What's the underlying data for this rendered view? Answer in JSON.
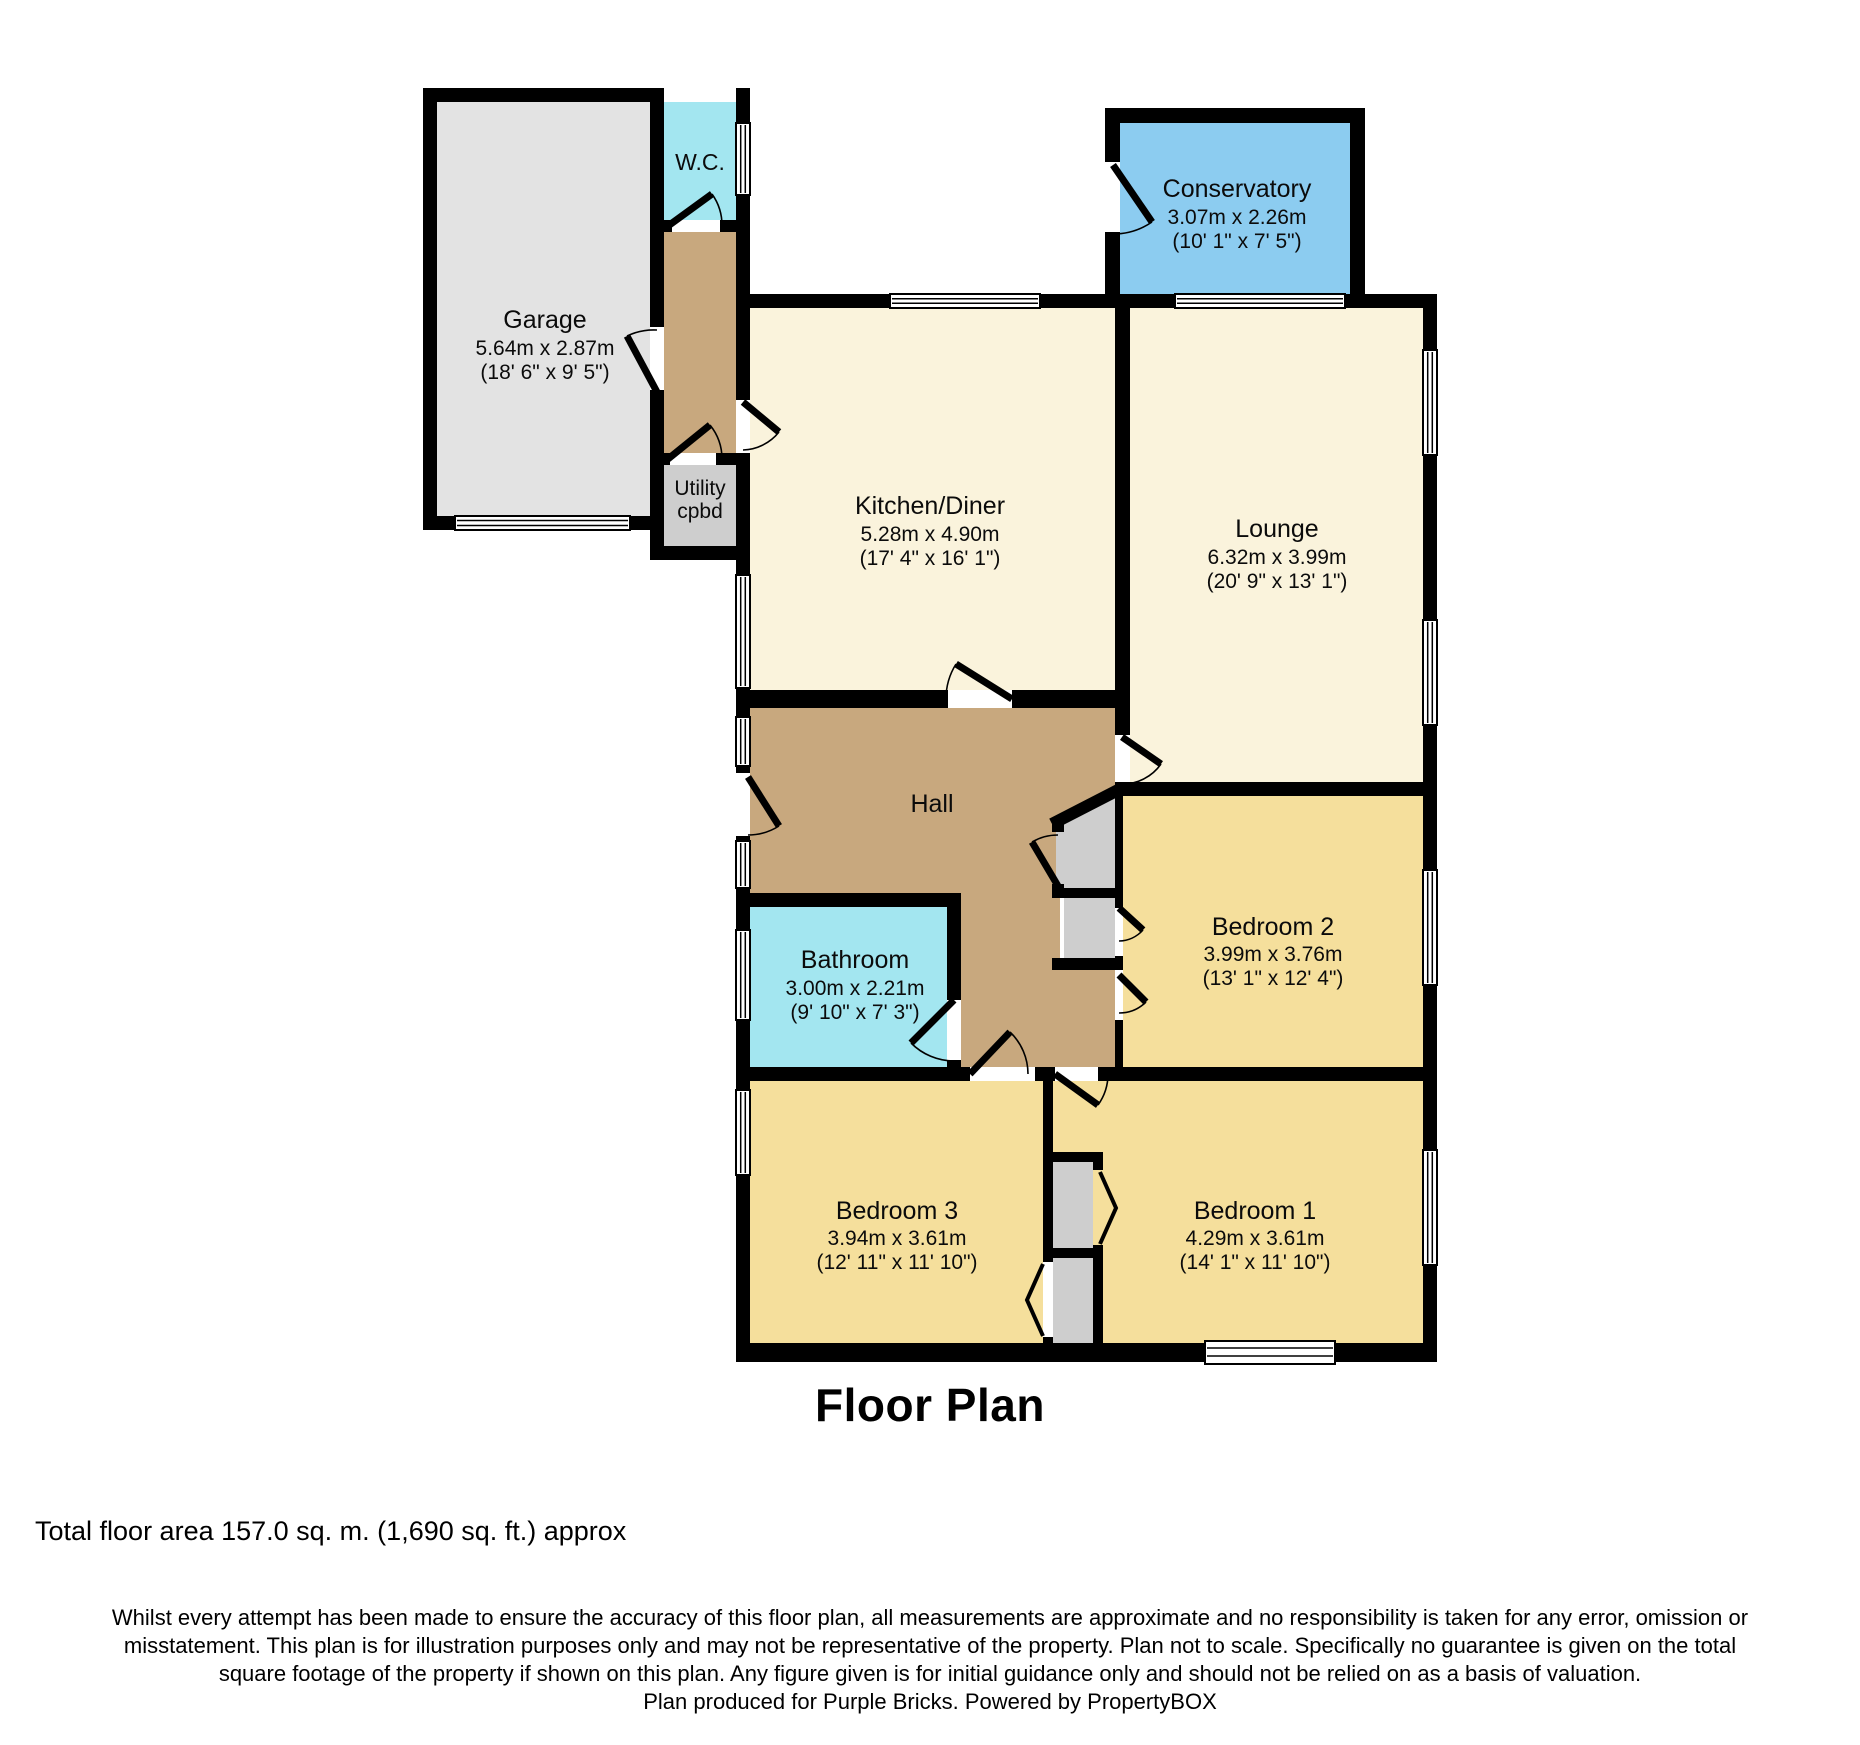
{
  "page": {
    "title": "Floor Plan",
    "total_area": "Total floor area 157.0 sq. m. (1,690 sq. ft.) approx"
  },
  "disclaimer": {
    "line1": "Whilst every attempt has been made to ensure the accuracy of this floor plan, all measurements are approximate and no responsibility is taken for any error, omission or",
    "line2": "misstatement. This plan is for illustration purposes only and may not be representative of the property. Plan not to scale. Specifically no guarantee is given on the total",
    "line3": "square footage of the property if shown on this plan. Any figure given is for initial guidance only and should not be relied on as a basis of valuation.",
    "line4": "Plan produced for Purple Bricks. Powered by PropertyBOX"
  },
  "rooms": {
    "garage": {
      "name": "Garage",
      "dims_m": "5.64m x 2.87m",
      "dims_ft": "(18' 6\" x 9' 5\")"
    },
    "wc": {
      "name": "W.C."
    },
    "utility": {
      "name": "Utility",
      "name2": "cpbd"
    },
    "kitchen": {
      "name": "Kitchen/Diner",
      "dims_m": "5.28m x 4.90m",
      "dims_ft": "(17' 4\" x 16' 1\")"
    },
    "conservatory": {
      "name": "Conservatory",
      "dims_m": "3.07m x 2.26m",
      "dims_ft": "(10' 1\" x 7' 5\")"
    },
    "lounge": {
      "name": "Lounge",
      "dims_m": "6.32m x 3.99m",
      "dims_ft": "(20' 9\" x 13' 1\")"
    },
    "hall": {
      "name": "Hall"
    },
    "bathroom": {
      "name": "Bathroom",
      "dims_m": "3.00m x 2.21m",
      "dims_ft": "(9' 10\" x 7' 3\")"
    },
    "bedroom2": {
      "name": "Bedroom 2",
      "dims_m": "3.99m x 3.76m",
      "dims_ft": "(13' 1\" x 12' 4\")"
    },
    "bedroom3": {
      "name": "Bedroom 3",
      "dims_m": "3.94m x 3.61m",
      "dims_ft": "(12' 11\" x 11' 10\")"
    },
    "bedroom1": {
      "name": "Bedroom 1",
      "dims_m": "4.29m x 3.61m",
      "dims_ft": "(14' 1\" x 11' 10\")"
    }
  },
  "colors": {
    "wall": "#000000",
    "cream": "#faf3dc",
    "tan": "#c8a87e",
    "yellow": "#f5df9c",
    "cyan": "#a3e6f0",
    "blue": "#8cccf0",
    "garage_gray": "#e3e3e3",
    "cupboard_gray": "#cecece",
    "window_white": "#ffffff"
  }
}
